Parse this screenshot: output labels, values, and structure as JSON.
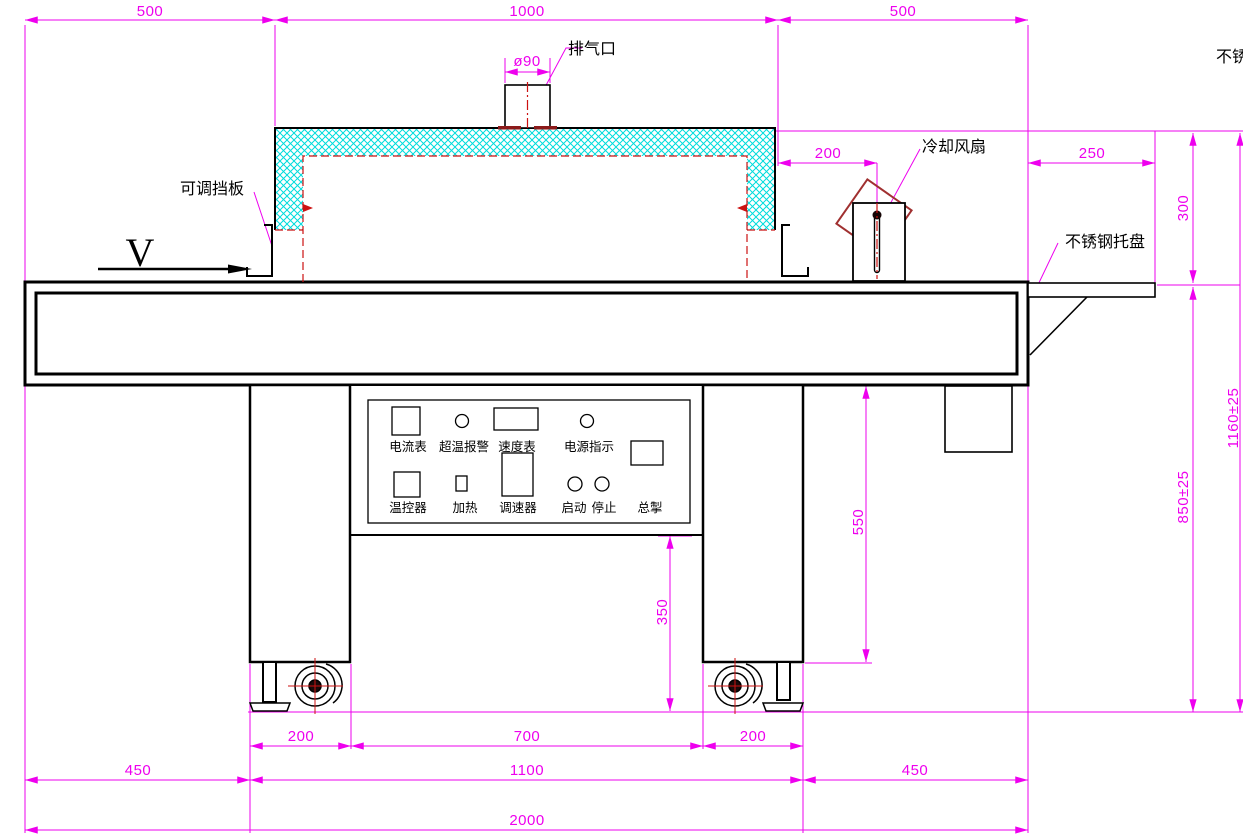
{
  "view": {
    "direction_label": "V"
  },
  "annotations": {
    "exhaust_port": "排气口",
    "adjustable_baffle": "可调挡板",
    "cooling_fan": "冷却风扇",
    "stainless_tray": "不锈钢托盘",
    "top_right_clipped": "不锈"
  },
  "control_panel": {
    "ammeter": "电流表",
    "overtemp_alarm": "超温报警",
    "speed_meter": "速度表",
    "power_indicator": "电源指示",
    "temp_controller": "温控器",
    "heating": "加热",
    "speed_governor": "调速器",
    "start": "启动",
    "stop": "停止",
    "master_switch": "总掣"
  },
  "dimensions": {
    "top_left": "500",
    "top_middle": "1000",
    "top_right": "500",
    "exhaust_diameter": "ø90",
    "fan_offset": "200",
    "tray_length": "250",
    "tray_drop": "300",
    "total_height": "1160±25",
    "belt_height": "850±25",
    "leg_height": "550",
    "panel_to_ground": "350",
    "left_leg_width": "200",
    "leg_spacing": "700",
    "right_leg_width": "200",
    "bottom_left": "450",
    "leg_span": "1100",
    "bottom_right": "450",
    "total_length": "2000"
  },
  "colors": {
    "dimension": "#ee00ee",
    "drawing_line": "#000000",
    "centerline_red": "#cc1111",
    "hatch_cyan": "#00dcdc",
    "flange_dark_red": "#8b1a1a"
  }
}
